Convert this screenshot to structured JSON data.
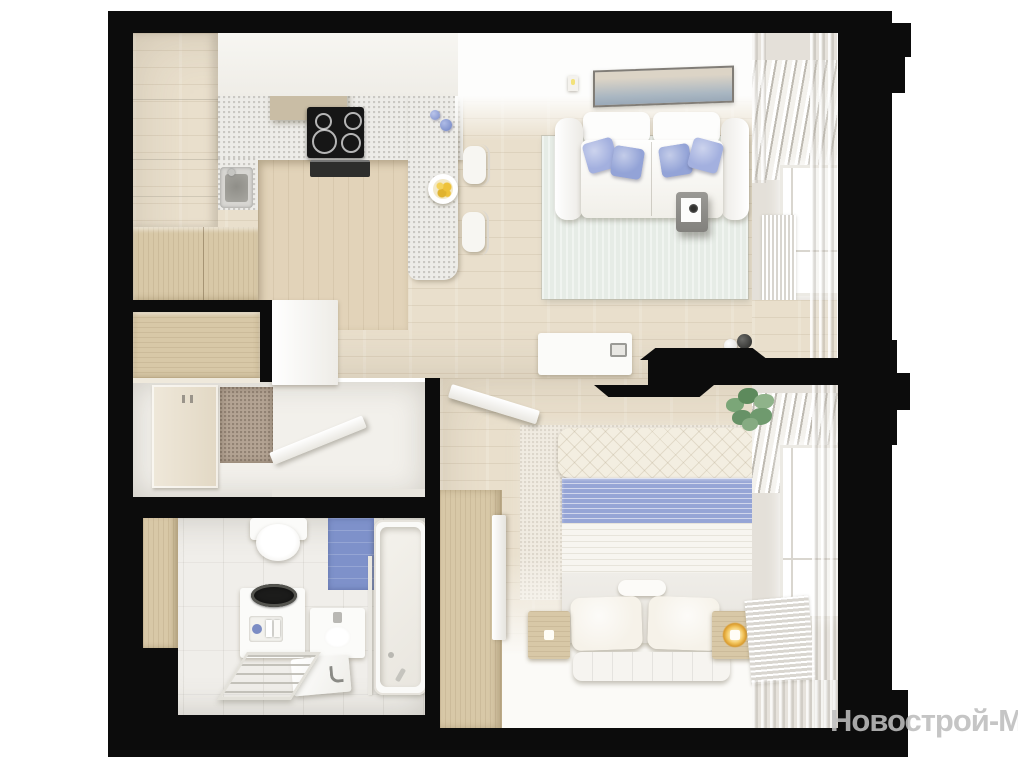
{
  "watermark": {
    "text": "Новострой-М"
  },
  "scene": {
    "type": "3d-top-down-apartment-floor-plan-render",
    "rooms": [
      "kitchen-living-room",
      "hallway",
      "bathroom",
      "bedroom"
    ],
    "items": [
      "kitchen-cabinets",
      "range-hood",
      "cooktop",
      "oven",
      "kitchen-sink",
      "bar-counter",
      "bar-stools",
      "fruit-plate",
      "pendant-lamps",
      "sofa",
      "lavender-pillows",
      "wall-art",
      "sconces",
      "mint-rug",
      "side-table",
      "tv-console",
      "decor-vases",
      "wall-tv",
      "entrance-door",
      "doormat",
      "hallway-wardrobe",
      "shoe-cabinet",
      "closet-door",
      "toilet",
      "washing-machine",
      "bathroom-vanity",
      "bathtub",
      "towel-ladder",
      "blue-tile-accent",
      "bed",
      "blue-striped-blanket",
      "bed-pillows",
      "nightstands",
      "bedside-lamps",
      "bed-bench",
      "bedroom-wardrobe",
      "bedroom-door",
      "potted-plant",
      "windows",
      "curtains",
      "radiators"
    ]
  },
  "palette": {
    "wall": "#0c0c0c",
    "background": "#ffffff",
    "floor_wood": "#e9dfcc",
    "floor_wood_dark": "#e2d3b9",
    "floor_light": "#f2f0eb",
    "bath_floor": "#f0eeea",
    "wood_cabinet": "#d8c8a7",
    "white_furniture": "#fbfbf9",
    "pillow_lavender": "#a3b0df",
    "pillow_lavender_dark": "#93a3d7",
    "blanket_blue": "#96a5d6",
    "tile_blue": "#7e91ca",
    "rug_mint": "#e6ece6",
    "rug_bedroom": "#f0ebe1",
    "lemon_yellow": "#eec23a",
    "lamp_gold": "#edb24a",
    "plant_green": "#6f9a6e",
    "curtain_gray": "#e4e0d9",
    "doormat_brown": "#b3a393",
    "watermark_gray": "#bebebe"
  }
}
